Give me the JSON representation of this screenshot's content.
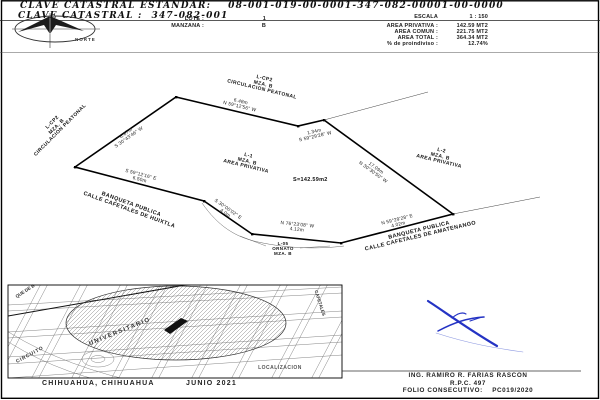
{
  "doc": {
    "header": {
      "clave_estandar_label": "CLAVE CATASTRAL ESTANDAR:",
      "clave_estandar_value": "08-001-019-00-0001-347-082-00001-00-0000",
      "clave_label": "CLAVE CATASTRAL :",
      "clave_value": "347-082-001"
    },
    "north_label": "NORTE",
    "lot_info": {
      "lote_label": "LOTE :",
      "lote_value": "1",
      "manzana_label": "MANZANA :",
      "manzana_value": "B"
    },
    "scale_info": {
      "escala_label": "ESCALA",
      "escala_value": "1 : 150",
      "area_privativa_label": "AREA PRIVATIVA :",
      "area_privativa_value": "142.59 MT2",
      "area_comun_label": "AREA COMUN :",
      "area_comun_value": "221.75 MT2",
      "area_total_label": "AREA TOTAL :",
      "area_total_value": "364.34 MT2",
      "proindiviso_label": "% de proindiviso :",
      "proindiviso_value": "12.74%"
    }
  },
  "plan": {
    "lot1": {
      "l1": "L-1",
      "l2": "MZA. B",
      "l3": "AREA PRIVATIVA",
      "area": "S=142.59m2"
    },
    "lot2": {
      "l1": "L-2",
      "l2": "MZA. B",
      "l3": "AREA PRIVATIVA"
    },
    "cp2_left": {
      "l1": "L-CP2",
      "l2": "MZA. B",
      "l3": "CIRCULACION PEATONAL"
    },
    "cp2_top": {
      "l1": "L-CP2",
      "l2": "MZA. B",
      "l3": "CIRCULACION PEATONAL"
    },
    "ornato": {
      "l1": "L-05",
      "l2": "ORNATO",
      "l3": "MZA. B"
    },
    "banqueta_left": {
      "l1": "BANQUETA PUBLICA",
      "l2": "CALLE CAFETALES DE HUIXTLA"
    },
    "banqueta_right": {
      "l1": "BANQUETA PUBLICA",
      "l2": "CALLE CAFETALES DE AMATENANGO"
    },
    "edges": {
      "top": {
        "length": "6.48m",
        "bearing": "N 59°12'56\" W"
      },
      "jog": {
        "length": "1.34m",
        "bearing": "S 59°29'28\" W"
      },
      "right": {
        "length": "17.09m",
        "bearing": "N 30°30'50\" W"
      },
      "bottom_right": {
        "bearing": "N 59°29'28\" E",
        "length": "4.02m"
      },
      "bottom_mid": {
        "bearing": "N 76°23'08\" W",
        "length": "4.12m"
      },
      "bottom_diag": {
        "bearing": "S 30°00'02\" E",
        "length": "4.0m"
      },
      "bottom_left": {
        "bearing": "S 59°12'16\" E",
        "length": "6.50m"
      },
      "left": {
        "length": "6.87m",
        "bearing": "S 30°43'46\" W"
      }
    }
  },
  "map": {
    "street_parque": "QUE DE B",
    "street_universitario": "UNIVERSITARIO",
    "street_circuito": "CIRCUITO",
    "street_cafetales": "CAFETALES",
    "localizacion_label": "LOCALIZACION",
    "caption_city": "CHIHUAHUA, CHIHUAHUA",
    "caption_date": "JUNIO 2021"
  },
  "footer": {
    "engineer": "ING. RAMIRO R. FARIAS RASCON",
    "rpc": "R.P.C. 497",
    "folio": "FOLIO CONSECUTIVO:    PC019/2020"
  },
  "colors": {
    "ink": "#1a1a1a",
    "signature_blue": "#2433c4"
  }
}
